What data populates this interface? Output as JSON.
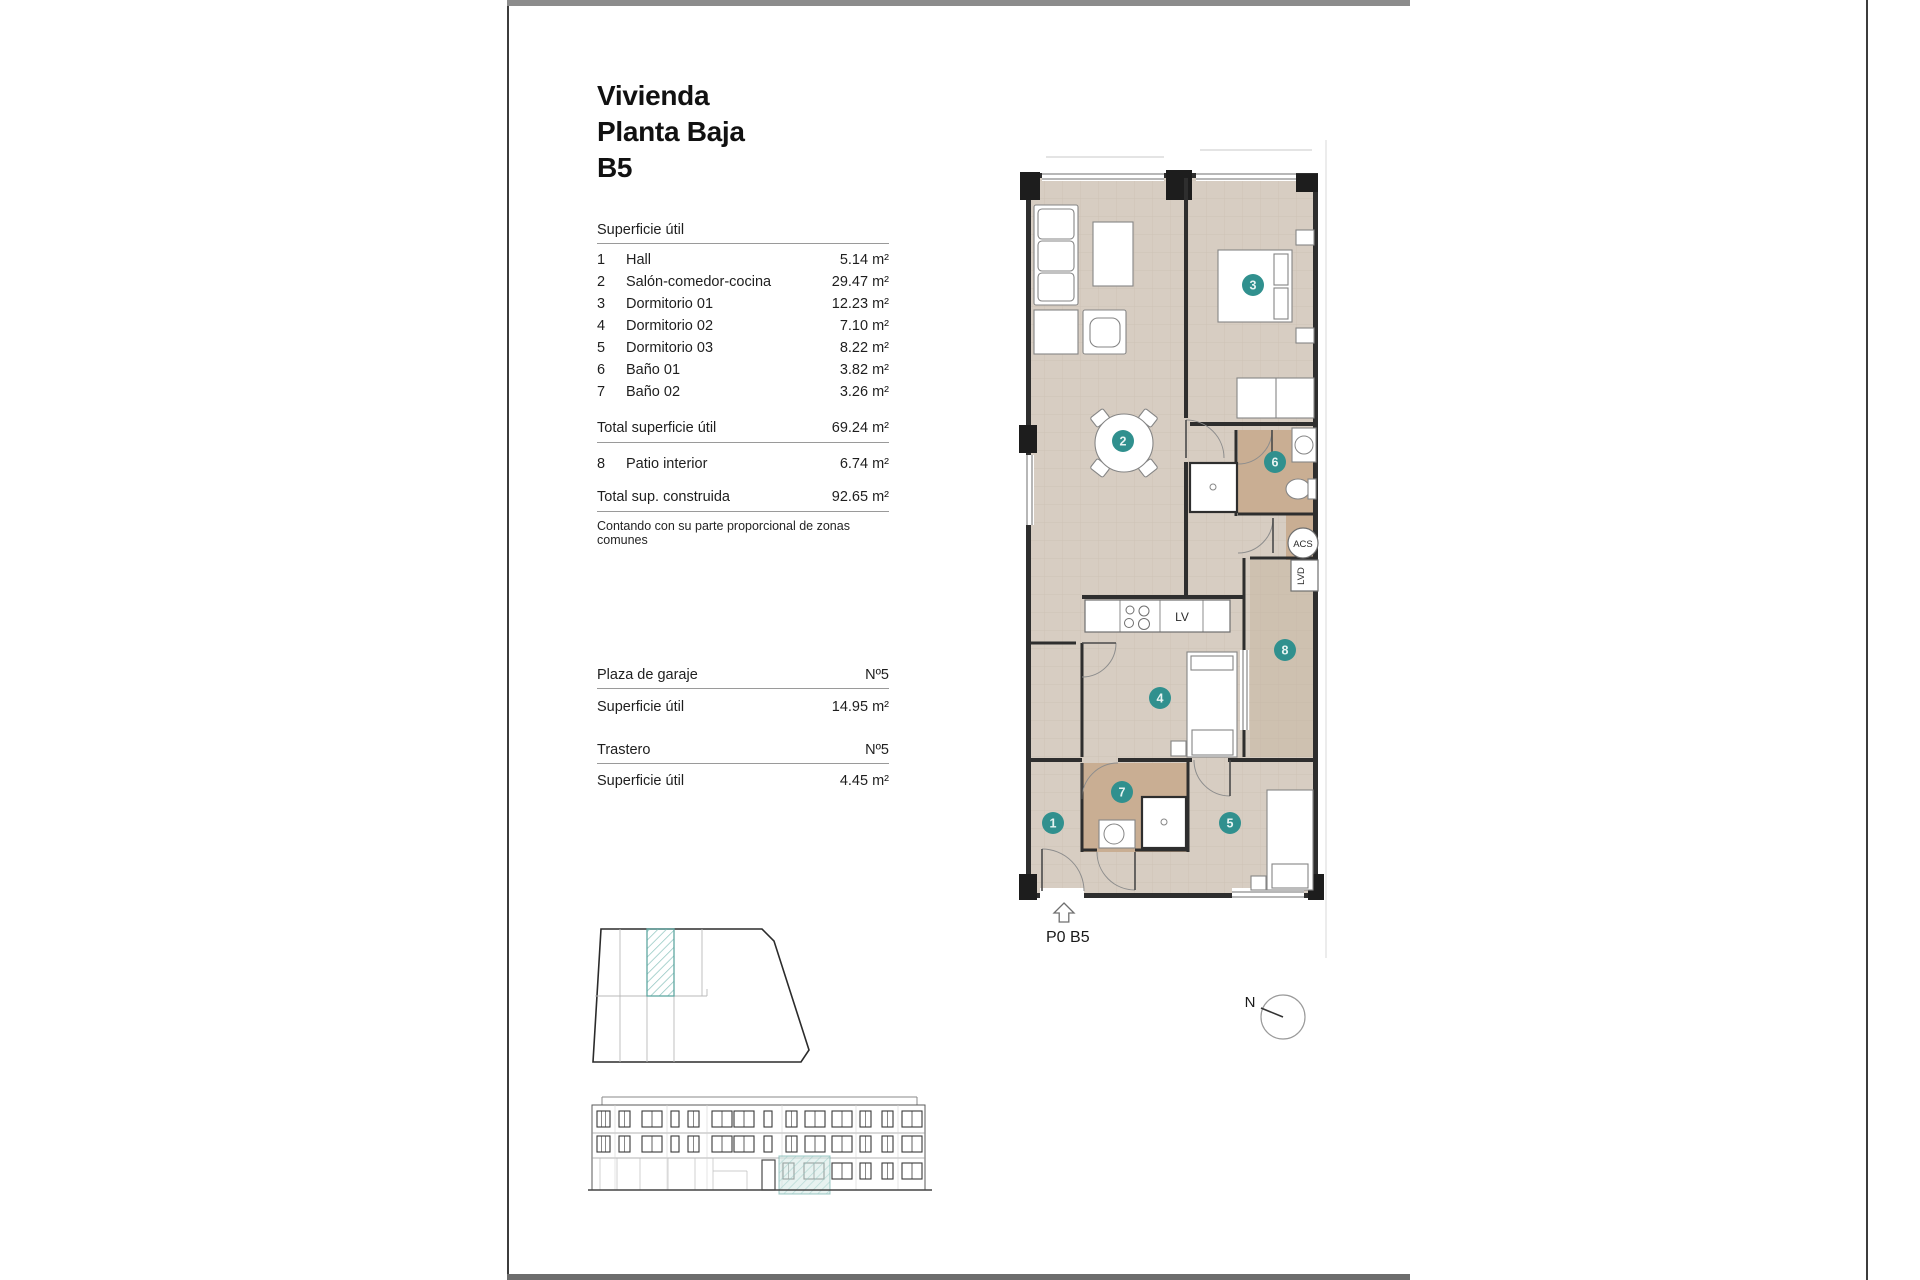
{
  "title": {
    "lines": [
      "Vivienda",
      "Planta Baja",
      "B5"
    ]
  },
  "surface": {
    "header": "Superficie útil",
    "rows": [
      {
        "num": "1",
        "name": "Hall",
        "value": "5.14 m²"
      },
      {
        "num": "2",
        "name": "Salón-comedor-cocina",
        "value": "29.47 m²"
      },
      {
        "num": "3",
        "name": "Dormitorio 01",
        "value": "12.23 m²"
      },
      {
        "num": "4",
        "name": "Dormitorio 02",
        "value": "7.10 m²"
      },
      {
        "num": "5",
        "name": "Dormitorio 03",
        "value": "8.22 m²"
      },
      {
        "num": "6",
        "name": "Baño 01",
        "value": "3.82 m²"
      },
      {
        "num": "7",
        "name": "Baño 02",
        "value": "3.26 m²"
      }
    ],
    "total_label": "Total superficie útil",
    "total_value": "69.24 m²",
    "patio": {
      "num": "8",
      "name": "Patio interior",
      "value": "6.74 m²"
    },
    "built_label": "Total sup. construida",
    "built_value": "92.65 m²",
    "note": "Contando con su parte proporcional de zonas comunes"
  },
  "garage": {
    "label": "Plaza de garaje",
    "number": "Nº5",
    "surface_label": "Superficie útil",
    "surface_value": "14.95 m²"
  },
  "storage": {
    "label": "Trastero",
    "number": "Nº5",
    "surface_label": "Superficie útil",
    "surface_value": "4.45 m²"
  },
  "plan": {
    "unit_label": "P0 B5",
    "badges": [
      "1",
      "2",
      "3",
      "4",
      "5",
      "6",
      "7",
      "8"
    ],
    "acs_label": "ACS",
    "lvd_label": "LVD",
    "dishwasher_label": "LV"
  },
  "compass": {
    "north": "N"
  },
  "colors": {
    "floor": "#d7cdc2",
    "bath": "#c9ae93",
    "patio": "#cec1b0",
    "badge": "#30908e",
    "highlight": "#5fa7a2"
  }
}
